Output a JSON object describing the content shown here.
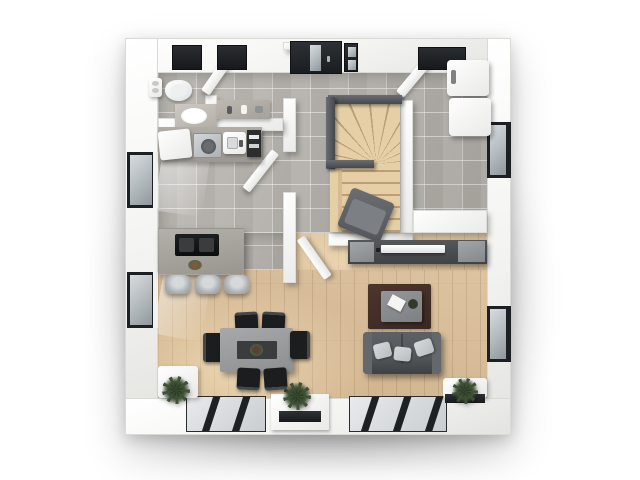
{
  "meta": {
    "description": "Top-down 3D architectural floor-plan rendering of a single-storey home: bathroom, kitchen, hallway with winder staircase, pantry, dining area and living room",
    "view": "3d-top-view",
    "background": "#ffffff"
  },
  "palette": {
    "wall": "#fafaf9",
    "tile_floor": "#b6b3ad",
    "wood_floor": "#d9bd97",
    "window_frame": "#1d2023",
    "glass": "#c6ccd0",
    "entrance_door": "#26292d",
    "stair_wood": "#e6cfa6",
    "handrail": "#55595d",
    "sofa": "#53565a",
    "cushion": "#c9ccce",
    "rug": "#43302a",
    "dining_table": "#9a9c9e",
    "chair": "#1f2123",
    "island": "#a7a49f",
    "cooktop": "#141515",
    "plant": "#3e5134",
    "appliance": "#f2f2f1"
  },
  "rooms": {
    "bathroom": {
      "label": "bathroom",
      "items": [
        "toilet",
        "washbasin",
        "vanity-counter",
        "toilet-paper-shelf",
        "frosted-window-left",
        "frosted-window-right",
        "open-door"
      ]
    },
    "kitchen": {
      "label": "kitchen",
      "items": [
        "corner-cabinet",
        "dishwasher",
        "sink-unit",
        "towel-shelf",
        "wall-window",
        "cooking-island",
        "induction-hob",
        "decor-bowl",
        "bar-stool-1",
        "bar-stool-2",
        "bar-stool-3",
        "open-door"
      ]
    },
    "hallway": {
      "label": "hallway",
      "items": [
        "entrance-door",
        "glass-sidelight",
        "winder-staircase",
        "handrail-top",
        "handrail-left",
        "handrail-mid",
        "reading-chair",
        "open-door-to-living"
      ]
    },
    "pantry": {
      "label": "pantry",
      "items": [
        "fridge-column",
        "freezer-column",
        "side-window",
        "transom-window",
        "open-door"
      ]
    },
    "dining": {
      "label": "dining area",
      "items": [
        "dining-table",
        "table-runner",
        "centerpiece",
        "chair-top-1",
        "chair-top-2",
        "chair-bottom-1",
        "chair-bottom-2",
        "chair-left",
        "chair-right",
        "side-window"
      ]
    },
    "living": {
      "label": "living room",
      "items": [
        "tv-sideboard",
        "tv",
        "speaker-left",
        "speaker-right",
        "rug",
        "coffee-table",
        "magazine",
        "decor-plant",
        "sofa",
        "cushion-1",
        "cushion-2",
        "cushion-3",
        "side-window"
      ]
    },
    "garden_side": {
      "label": "garden side",
      "items": [
        "sliding-door-left",
        "sliding-door-right",
        "planter-box",
        "potted-plant-left",
        "potted-plant-center",
        "potted-plant-right"
      ]
    }
  }
}
